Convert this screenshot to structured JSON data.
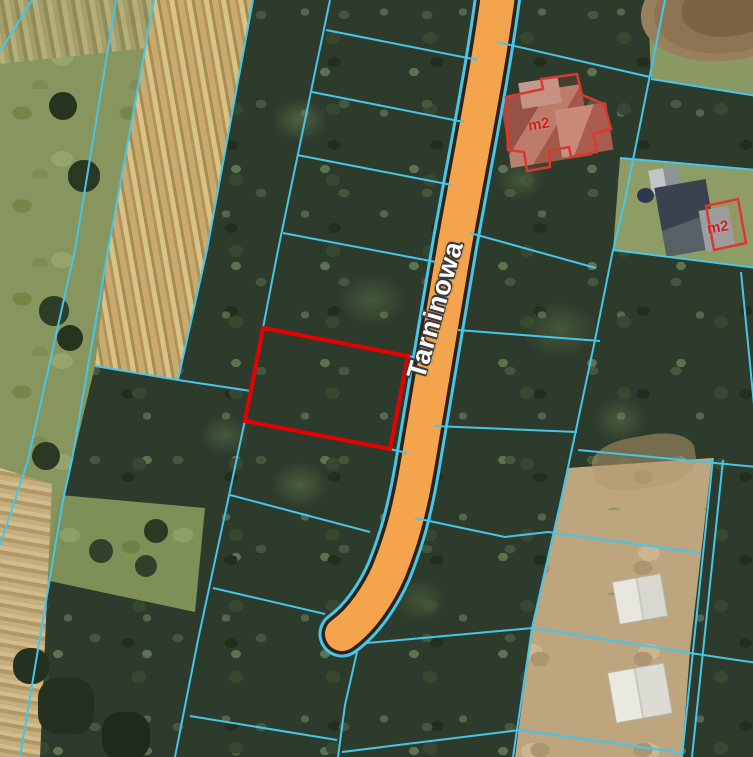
{
  "map": {
    "road": {
      "label": "Tarninowa"
    },
    "buildings": [
      {
        "label": "m2"
      },
      {
        "label": "m2"
      }
    ],
    "colors": {
      "parcel-line": "#45c6ea",
      "road-fill": "#f3a44c",
      "road-border": "#2e2216",
      "highlight-parcel": "#e60000",
      "building-outline": "#d93a2e",
      "building-label": "#cc2020"
    }
  }
}
